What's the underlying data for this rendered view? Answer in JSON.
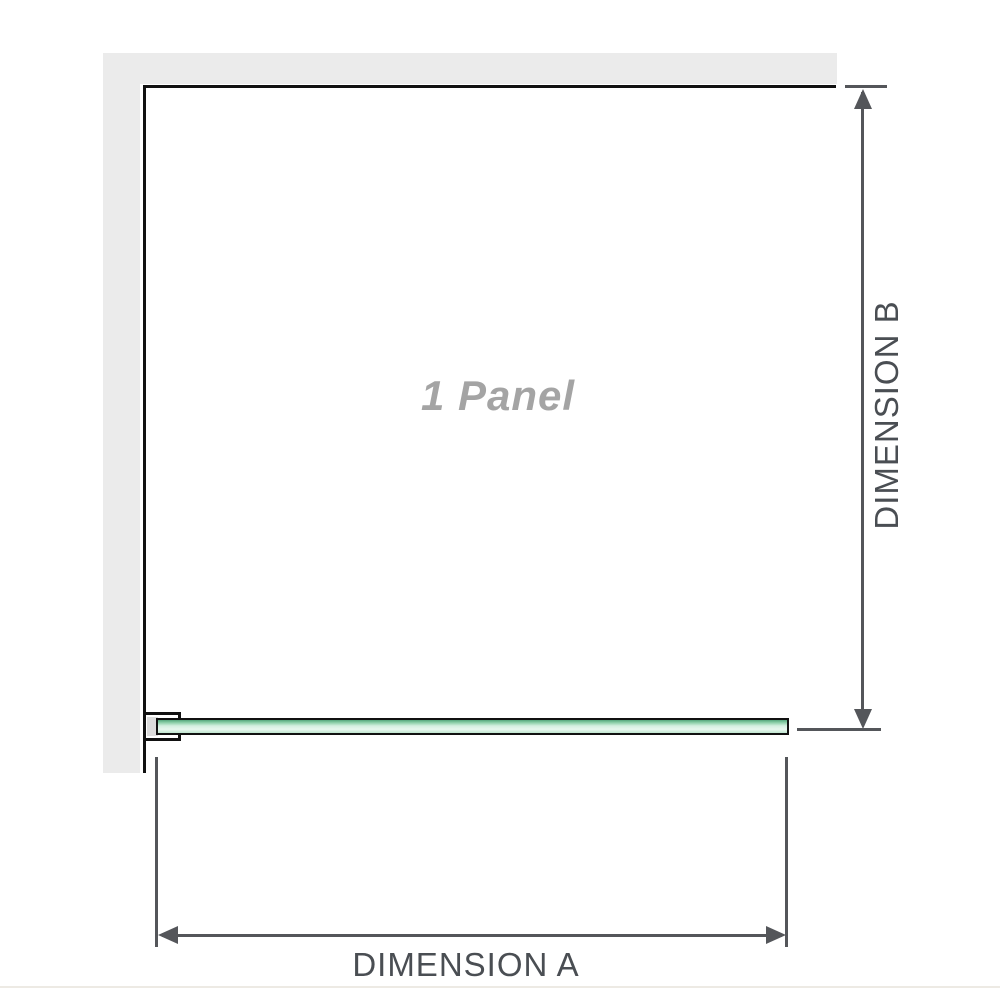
{
  "diagram": {
    "panel_label": "1 Panel",
    "dimension_a_label": "DIMENSION A",
    "dimension_b_label": "DIMENSION B"
  },
  "colors": {
    "background": "#ffffff",
    "wall_fill": "#ebebeb",
    "panel_outline": "#111111",
    "panel_label_text": "#a4a4a4",
    "dimension_line": "#54565a",
    "dimension_label_text": "#4a4e53",
    "glass_edge_dark": "#55a67c",
    "glass_fill_light": "#d4efe0",
    "clamp_inner_fill": "#dcdcdc",
    "footer_rule": "#edeae4"
  }
}
